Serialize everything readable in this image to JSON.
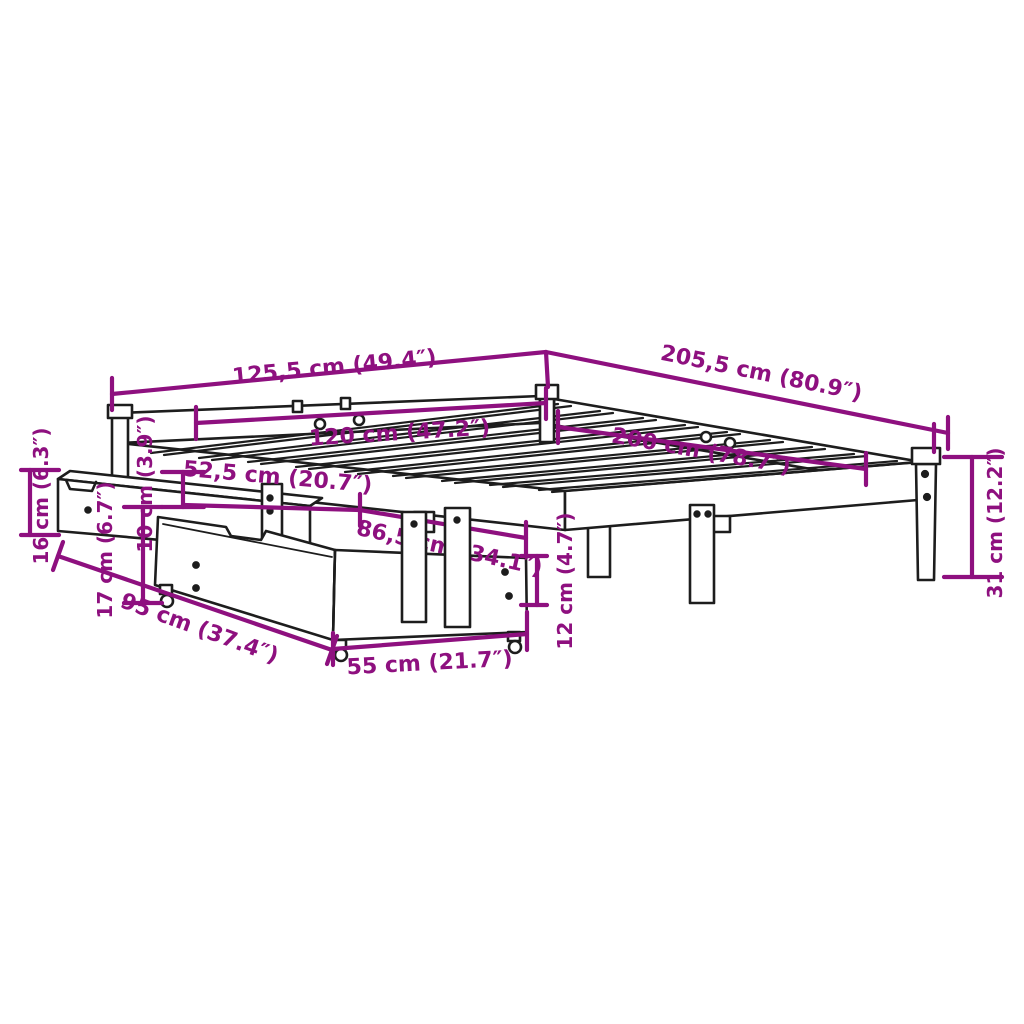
{
  "diagram": {
    "subject": "bed frame with slatted base and two storage drawers, isometric dimension drawing",
    "colors": {
      "dimension": "#8E107F",
      "outline": "#1D1D1D",
      "background": "#FFFFFF"
    }
  },
  "dims": {
    "overall_width": "125,5 cm (49.4″)",
    "overall_length": "205,5 cm (80.9″)",
    "inner_width": "120 cm (47.2″)",
    "inner_length": "200 cm (78.7″)",
    "head_side_clearance": "52,5 cm (20.7″)",
    "under_bed_clearance_length": "86,5 cm (34.1″)",
    "upper_drawer_height": "16 cm (6.3″)",
    "rail_height": "10 cm (3.9″)",
    "lower_drawer_height": "17 cm (6.7″)",
    "drawer_depth": "95 cm (37.4″)",
    "drawer_width": "55 cm (21.7″)",
    "under_drawer_height": "12 cm (4.7″)",
    "leg_height": "31 cm (12.2″)"
  }
}
